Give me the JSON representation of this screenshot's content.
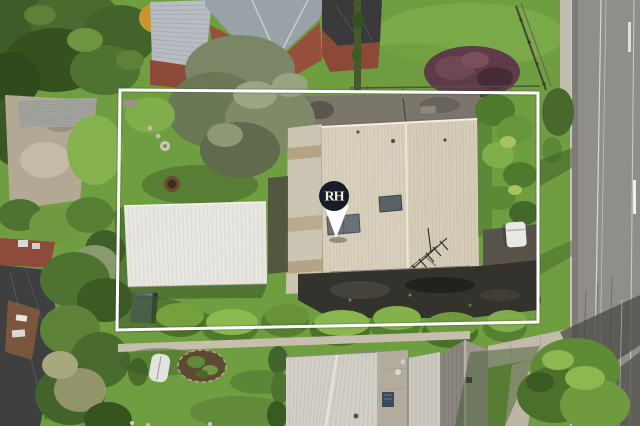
{
  "marker": {
    "label": "RH",
    "bg": "#161d28",
    "fg": "#f2ead8"
  },
  "boundary": {
    "color": "#ffffff"
  },
  "palette": {
    "lawn": "#6f9e41",
    "verge_lawn": "#74a344",
    "road": "#908e88",
    "main_roof": "#d8d0bd",
    "main_roof_right": "#d4ccb7",
    "garage_roof": "#e8e6e0",
    "bottom_house_roof": "#d2cfc7",
    "asphalt_court": "#34322d",
    "concrete_path": "#cdc5b4",
    "terracotta": "#9a4c31",
    "gray_hip_roof": "#99a2a9"
  }
}
